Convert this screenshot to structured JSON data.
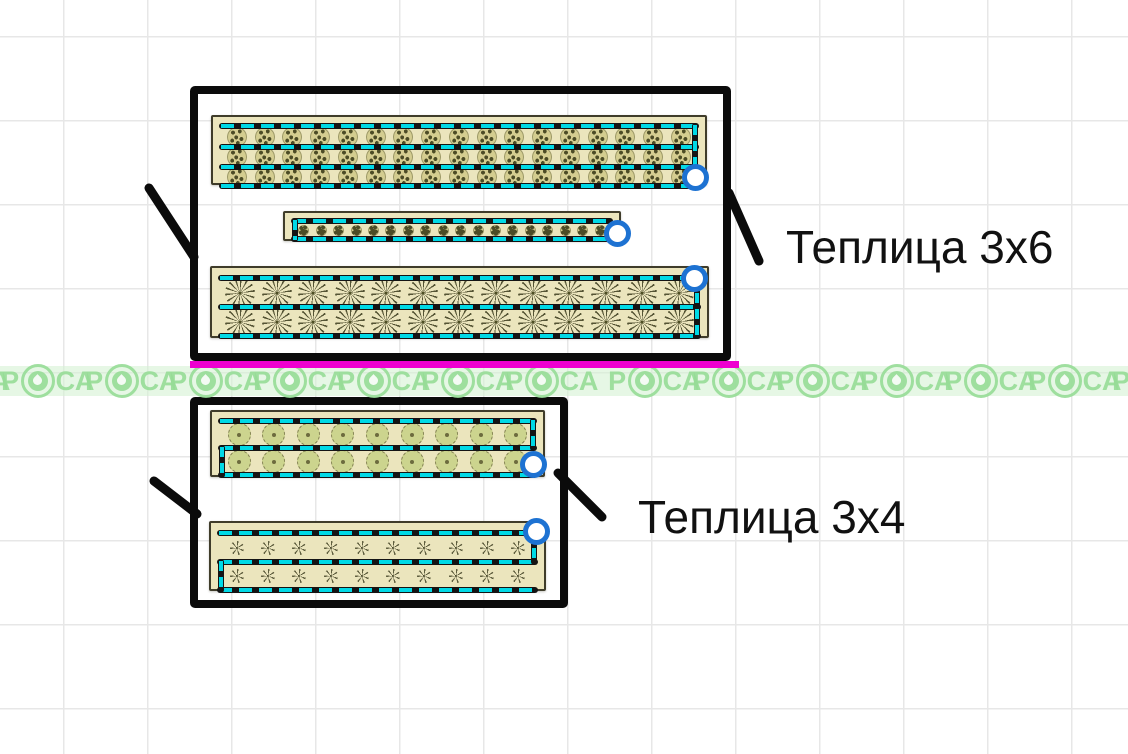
{
  "page": {
    "grid_size": 84,
    "grid_offset_x": 63,
    "grid_offset_y": 36
  },
  "colors": {
    "grid": "#e7e7e7",
    "drip_cyan": "#00d9e6",
    "bed_fill": "#ebe5bd",
    "bed_border": "#3f3c2a",
    "frame_black": "#0b0b0b",
    "handle_blue": "#1d72d2",
    "accent_magenta": "#ee00d0",
    "watermark_green": "rgba(150,220,150,0.9)",
    "watermark_band_bg": "rgba(214,241,212,0.6)",
    "label_text": "#111111"
  },
  "plant_sizes": {
    "shrub": 20,
    "tiny": 11,
    "spiky": 30,
    "round": 23,
    "star": 14
  },
  "watermark": {
    "full_text": "РОСА",
    "text_before": "Р",
    "text_after": "СА",
    "band_top": 366,
    "band_height": 30,
    "unit_width": 84,
    "strips": [
      {
        "x": -78,
        "units": 8
      },
      {
        "x": 613,
        "units": 7
      }
    ]
  },
  "greenhouses": [
    {
      "label": "Теплица 3x6",
      "label_pos": {
        "x": 786,
        "y": 222
      },
      "label_size": 46,
      "frame": {
        "x": 190,
        "y": 86,
        "w": 541,
        "h": 275
      },
      "accent_line": {
        "x": 190,
        "y": 361,
        "w": 549
      },
      "callouts": [
        {
          "x1": 149,
          "y1": 188,
          "x2": 194,
          "y2": 257
        },
        {
          "x1": 729,
          "y1": 193,
          "x2": 759,
          "y2": 261
        }
      ],
      "beds": [
        {
          "x": 211,
          "y": 115,
          "w": 496,
          "h": 70,
          "rows": 3,
          "plants": 17,
          "type": "shrub",
          "lines": [
            6,
            27,
            47,
            66
          ],
          "vconns": [
            {
              "side": "right",
              "top": 6,
              "bottom": 66
            }
          ],
          "handle": {
            "cx": 695,
            "cy": 177
          }
        },
        {
          "x": 283,
          "y": 211,
          "w": 338,
          "h": 30,
          "rows": 1,
          "plants": 18,
          "type": "tiny",
          "lines": [
            5,
            23
          ],
          "vconns": [
            {
              "side": "left",
              "top": 5,
              "bottom": 23
            }
          ],
          "handle": {
            "cx": 617,
            "cy": 233
          }
        },
        {
          "x": 210,
          "y": 266,
          "w": 499,
          "h": 72,
          "rows": 2,
          "plants": 13,
          "type": "spiky",
          "lines": [
            7,
            36,
            65
          ],
          "vconns": [
            {
              "side": "right",
              "top": 7,
              "bottom": 65
            }
          ],
          "handle": {
            "cx": 694,
            "cy": 278
          }
        }
      ]
    },
    {
      "label": "Теплица 3x4",
      "label_pos": {
        "x": 638,
        "y": 492
      },
      "label_size": 46,
      "frame": {
        "x": 190,
        "y": 397,
        "w": 378,
        "h": 211
      },
      "callouts": [
        {
          "x1": 154,
          "y1": 481,
          "x2": 197,
          "y2": 514
        },
        {
          "x1": 558,
          "y1": 473,
          "x2": 602,
          "y2": 517
        }
      ],
      "beds": [
        {
          "x": 210,
          "y": 410,
          "w": 335,
          "h": 67,
          "rows": 2,
          "plants": 9,
          "type": "round",
          "lines": [
            6,
            33,
            60
          ],
          "vconns": [
            {
              "side": "right",
              "top": 6,
              "bottom": 33
            },
            {
              "side": "left",
              "top": 33,
              "bottom": 60
            }
          ],
          "handle": {
            "cx": 533,
            "cy": 464
          }
        },
        {
          "x": 209,
          "y": 521,
          "w": 337,
          "h": 70,
          "rows": 2,
          "plants": 10,
          "type": "star",
          "lines": [
            7,
            36,
            64
          ],
          "vconns": [
            {
              "side": "right",
              "top": 7,
              "bottom": 36
            },
            {
              "side": "left",
              "top": 36,
              "bottom": 64
            }
          ],
          "handle": {
            "cx": 536,
            "cy": 531
          }
        }
      ]
    }
  ]
}
